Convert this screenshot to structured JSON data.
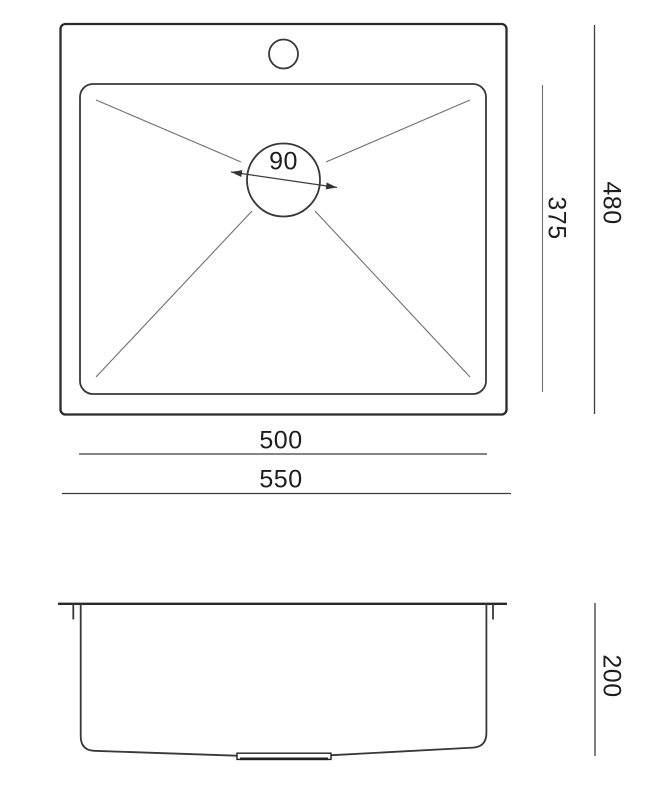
{
  "colors": {
    "line": "#2a2a2a",
    "thin_line": "#6f6f6f",
    "text": "#1d1d1d",
    "background": "#ffffff"
  },
  "top_view": {
    "drain_diameter_label": "90",
    "bowl_width_label": "375",
    "overall_width_label": "480",
    "bowl_length_label": "500",
    "overall_length_label": "550"
  },
  "side_view": {
    "depth_label": "200"
  }
}
